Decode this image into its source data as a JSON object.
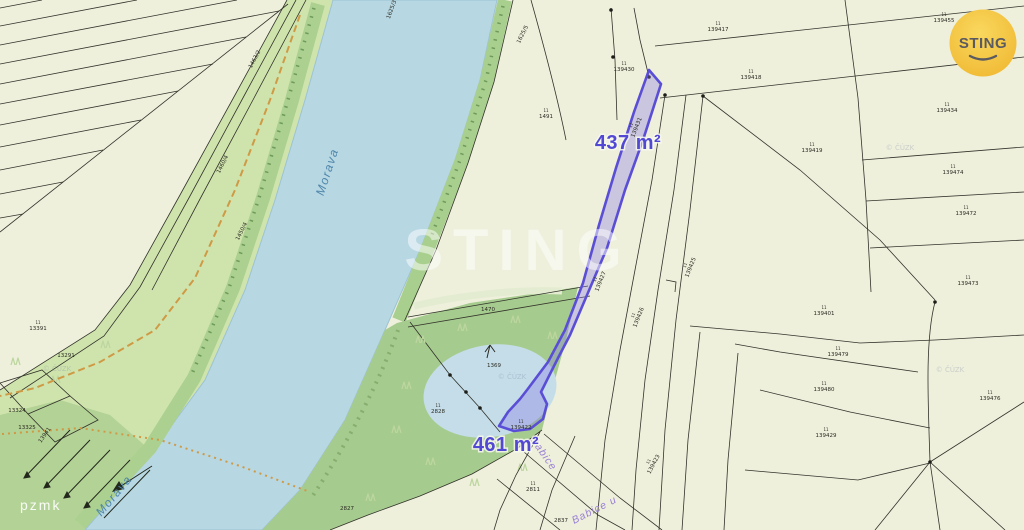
{
  "logo": {
    "text": "STING"
  },
  "watermark": {
    "text": "STING"
  },
  "corner_text": "pzmk",
  "highlights": {
    "area_top": "437 m²",
    "area_bottom": "461 m²"
  },
  "river": {
    "name": "Morava"
  },
  "parcel_sup_mark": "11",
  "streets": [
    {
      "x": 530,
      "y": 440,
      "r": 55,
      "text": "Babice"
    },
    {
      "x": 574,
      "y": 524,
      "r": -27,
      "text": "Babice u"
    }
  ],
  "copyright_marks": [
    {
      "x": 900,
      "y": 150,
      "text": "© ČÚZK"
    },
    {
      "x": 950,
      "y": 372,
      "text": "© ČÚZK"
    },
    {
      "x": 512,
      "y": 379,
      "text": "© ČÚZK"
    },
    {
      "x": 57,
      "y": 371,
      "text": "© ČÚZK"
    }
  ],
  "parcel_labels": [
    {
      "x": 944,
      "y": 22,
      "t": "139455",
      "s": 1
    },
    {
      "x": 718,
      "y": 31,
      "t": "139417",
      "s": 1
    },
    {
      "x": 751,
      "y": 79,
      "t": "139418",
      "s": 1
    },
    {
      "x": 812,
      "y": 152,
      "t": "139419",
      "s": 1
    },
    {
      "x": 947,
      "y": 112,
      "t": "139434",
      "s": 1
    },
    {
      "x": 953,
      "y": 174,
      "t": "139474",
      "s": 1
    },
    {
      "x": 966,
      "y": 215,
      "t": "139472",
      "s": 1
    },
    {
      "x": 968,
      "y": 285,
      "t": "139473",
      "s": 1
    },
    {
      "x": 824,
      "y": 315,
      "t": "139401",
      "s": 1
    },
    {
      "x": 838,
      "y": 356,
      "t": "139479",
      "s": 1
    },
    {
      "x": 824,
      "y": 391,
      "t": "139480",
      "s": 1
    },
    {
      "x": 826,
      "y": 437,
      "t": "139429",
      "s": 1
    },
    {
      "x": 990,
      "y": 400,
      "t": "139476",
      "s": 1
    },
    {
      "x": 624,
      "y": 71,
      "t": "139430",
      "s": 1
    },
    {
      "x": 546,
      "y": 118,
      "t": "1491",
      "s": 1
    },
    {
      "x": 638,
      "y": 128,
      "t": "139431",
      "r": -68,
      "s": 1
    },
    {
      "x": 602,
      "y": 282,
      "t": "139427",
      "r": -68,
      "s": 1
    },
    {
      "x": 640,
      "y": 318,
      "t": "139426",
      "r": -68,
      "s": 1
    },
    {
      "x": 692,
      "y": 268,
      "t": "139425",
      "r": -68,
      "s": 1
    },
    {
      "x": 655,
      "y": 465,
      "t": "139423",
      "r": -62,
      "s": 1
    },
    {
      "x": 521,
      "y": 429,
      "t": "139422",
      "s": 1
    },
    {
      "x": 494,
      "y": 367,
      "t": "1369"
    },
    {
      "x": 438,
      "y": 413,
      "t": "2828",
      "s": 1
    },
    {
      "x": 488,
      "y": 311,
      "t": "1470"
    },
    {
      "x": 533,
      "y": 491,
      "t": "2811",
      "s": 1
    },
    {
      "x": 561,
      "y": 522,
      "t": "2837"
    },
    {
      "x": 347,
      "y": 510,
      "t": "2827"
    },
    {
      "x": 38,
      "y": 330,
      "t": "13391",
      "s": 1
    },
    {
      "x": 66,
      "y": 357,
      "t": "13291"
    },
    {
      "x": 17,
      "y": 412,
      "t": "13324"
    },
    {
      "x": 27,
      "y": 429,
      "t": "13325"
    },
    {
      "x": 46,
      "y": 436,
      "t": "13941",
      "r": -55
    },
    {
      "x": 256,
      "y": 60,
      "t": "1463/2",
      "r": -62
    },
    {
      "x": 224,
      "y": 165,
      "t": "1460/4",
      "r": -63
    },
    {
      "x": 243,
      "y": 232,
      "t": "1450/4",
      "r": -63
    },
    {
      "x": 524,
      "y": 35,
      "t": "1625/5",
      "r": -64
    },
    {
      "x": 393,
      "y": 10,
      "t": "1625/3",
      "r": -70
    }
  ],
  "colors": {
    "background": "#eef0dc",
    "water": "#b7d7e3",
    "green_corridor": "#cfe4ad",
    "woods": "#a6cb8e",
    "highlight_stroke": "#5b4ed6",
    "highlight_fill": "rgba(132,116,230,0.34)",
    "path_orange": "#cf9a45",
    "logo_yellow": "#f5c344",
    "area_label": "#5148d4"
  }
}
